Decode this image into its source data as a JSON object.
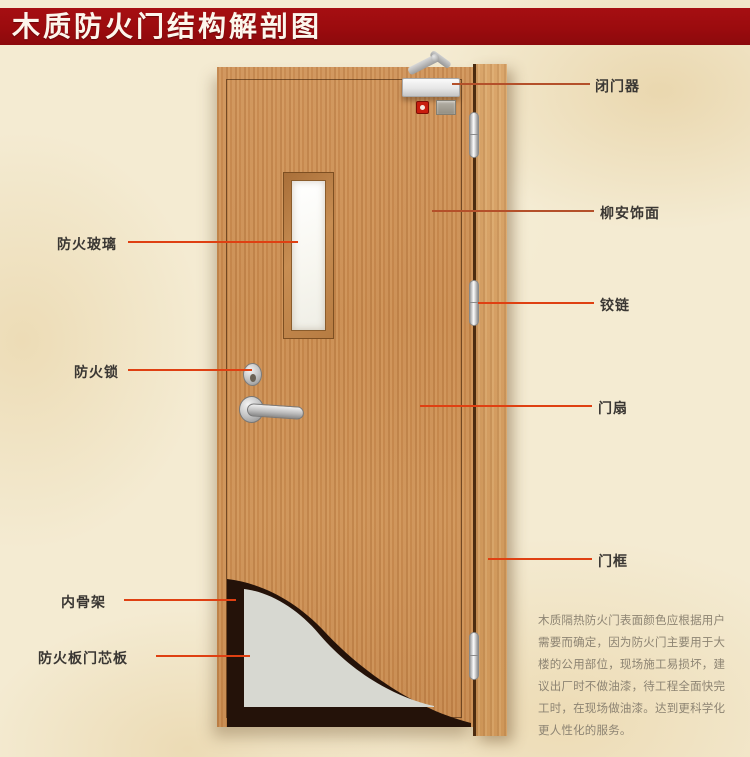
{
  "title": "木质防火门结构解剖图",
  "labels": {
    "fire_glass": "防火玻璃",
    "fire_lock": "防火锁",
    "inner_skeleton": "内骨架",
    "fire_board_core": "防火板门芯板",
    "door_closer": "闭门器",
    "lauan_veneer": "柳安饰面",
    "hinge": "铰链",
    "door_leaf": "门扇",
    "door_frame": "门框"
  },
  "description": {
    "lines": [
      "木质隔热防火门表面颜色应根据用户",
      "需要而确定，因为防火门主要用于大",
      "楼的公用部位，现场施工易损坏，建",
      "议出厂时不做油漆，待工程全面快完",
      "工时，在现场做油漆。达到更科学化",
      "更人性化的服务。"
    ]
  },
  "colors": {
    "banner_red": "#9b0b0e",
    "background_beige": "#f4ebd2",
    "door_wood": "#c98a4e",
    "frame_wood": "#d29b5f",
    "leader_line": "#df4012",
    "core_gray": "#d7d8d1",
    "skeleton_dark": "#241209",
    "glass_white": "#f7f6ef",
    "alarm_red": "#c91d0e"
  }
}
